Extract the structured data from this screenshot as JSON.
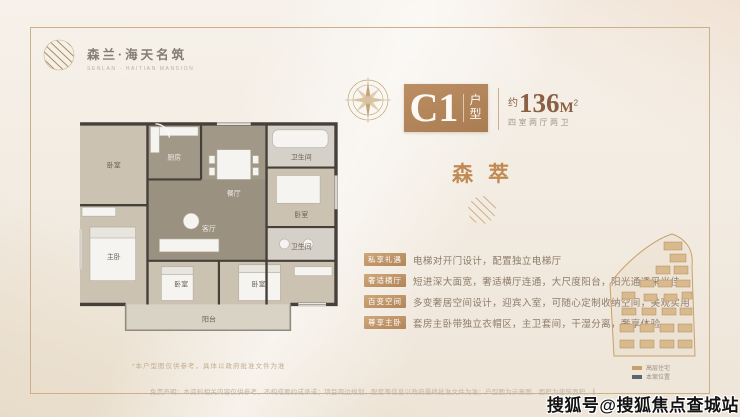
{
  "colors": {
    "accent_gold": "#c9a06a",
    "unit_box_brown": "#b2845a",
    "area_brown": "#8a5f44",
    "frame_line": "#cdb089",
    "legend_building": "#c9a06a",
    "legend_site": "#5b6670"
  },
  "logo": {
    "name": "森兰·海天名筑",
    "sub": "SENLAN · HAITIAN MANSION"
  },
  "header": {
    "unit_code": "C1",
    "unit_type_char1": "户",
    "unit_type_char2": "型",
    "area_prefix": "约",
    "area_number": "136",
    "area_unit": "M",
    "area_sup": "2",
    "spec": "四室两厅两卫"
  },
  "theme": {
    "title": "森萃"
  },
  "features": [
    {
      "label": "私享礼遇",
      "desc": "电梯对开门设计，配置独立电梯厅"
    },
    {
      "label": "奢适横厅",
      "desc": "短进深大面宽，奢适横厅连通，大尺度阳台，阳光通透采光佳"
    },
    {
      "label": "百变空间",
      "desc": "多变奢居空间设计，迎宾入室，可随心定制收纳空间，美观实用"
    },
    {
      "label": "尊享主卧",
      "desc": "套房主卧带独立衣帽区，主卫套间，干湿分离，奢享体验"
    }
  ],
  "floor_plan": {
    "caption": "*本户型图仅供参考，具体以政府批准文件为准",
    "rooms": {
      "bedroom_tl": "卧室",
      "master": "主卧",
      "kitchen": "厨房",
      "dining": "餐厅",
      "bath1": "卫生间",
      "bedroom_r": "卧室",
      "living": "客厅",
      "bath2": "卫生间",
      "bedroom_b1": "卧室",
      "bedroom_b2": "卧室",
      "balcony": "阳台"
    }
  },
  "site_plan": {
    "legend": [
      {
        "label": "高层住宅",
        "color": "#c9a06a"
      },
      {
        "label": "本案位置",
        "color": "#5b6670"
      }
    ]
  },
  "footer": {
    "disclaimer": "免责声明：本资料相关内容仅供参考，不构成要约或承诺；项目周边规划、配套等信息以政府最终批准文件为准；户型图为示意图，面积为建筑面积，最终以实测及商品房买卖合同约定为准。"
  },
  "watermark": {
    "text": "搜狐号@搜狐焦点查城站"
  }
}
